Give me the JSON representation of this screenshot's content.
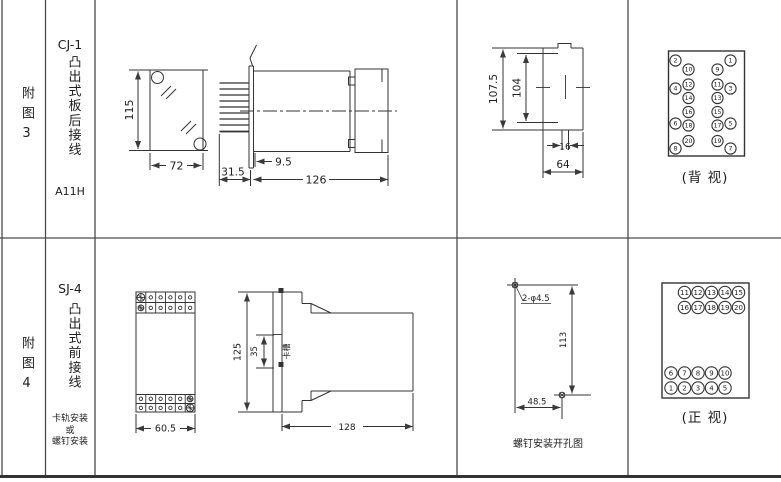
{
  "sheet": {
    "background": "#ffffff",
    "line_color": "#3a3a3a"
  },
  "fig3": {
    "index_label": "附图3",
    "model": "CJ-1",
    "mount_type": "凸出式板后接线",
    "code": "A11H",
    "view_caption": "(背 视)",
    "dims": {
      "panel_height": "115",
      "panel_width": "72",
      "pin_length": "31.5",
      "collar_depth": "9.5",
      "body_length": "126",
      "cutout_outer_height": "107.5",
      "cutout_inner_height": "104",
      "stud_width": "16",
      "cutout_width": "64"
    },
    "terminals": {
      "outer_left": [
        "2",
        "4",
        "6",
        "8"
      ],
      "inner_left": [
        "10",
        "12",
        "14",
        "16",
        "18",
        "20"
      ],
      "inner_right": [
        "9",
        "11",
        "13",
        "15",
        "17",
        "19"
      ],
      "outer_right": [
        "1",
        "3",
        "5",
        "7"
      ]
    }
  },
  "fig4": {
    "index_label": "附图4",
    "model": "SJ-4",
    "mount_type": "凸出式前接线",
    "mount_note_lines": [
      "卡轨安装",
      "或",
      "螺钉安装"
    ],
    "view_caption": "(正 视)",
    "drill_caption": "螺钉安装开孔图",
    "dims": {
      "front_width": "60.5",
      "front_height": "125",
      "slot_height": "35",
      "slot_label": "卡槽",
      "body_length": "128",
      "hole_spec": "2-φ4.5",
      "hole_spacing_v": "113",
      "hole_spacing_h": "48.5"
    },
    "terminals": {
      "top_rows": [
        [
          "11",
          "12",
          "13",
          "14",
          "15"
        ],
        [
          "16",
          "17",
          "18",
          "19",
          "20"
        ]
      ],
      "bottom_rows": [
        [
          "6",
          "7",
          "8",
          "9",
          "10"
        ],
        [
          "1",
          "2",
          "3",
          "4",
          "5"
        ]
      ]
    }
  }
}
